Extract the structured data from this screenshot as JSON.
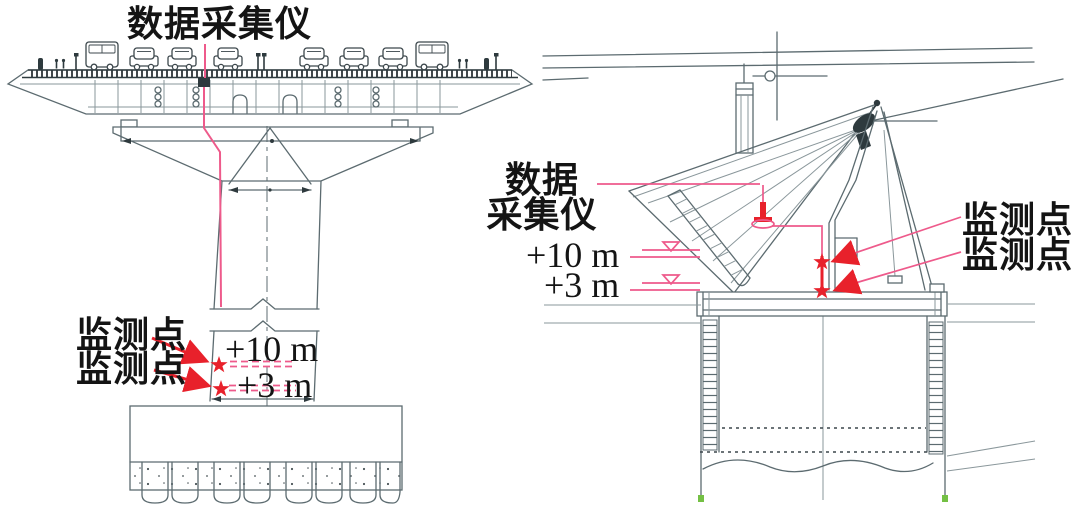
{
  "left_view": {
    "daq_label": "数据采集仪",
    "monitoring_points": [
      "监测点",
      "监测点"
    ],
    "elevations": [
      "+10 m",
      "+3 m"
    ]
  },
  "right_view": {
    "daq_label_lines": [
      "数据",
      "采集仪"
    ],
    "elevations": [
      "+10 m",
      "+3 m"
    ],
    "monitoring_points": [
      "监测点",
      "监测点"
    ]
  },
  "colors": {
    "drawing_line": "#5c6b70",
    "dark_detail": "#2e3a3e",
    "annotation_pink": "#ee5a8b",
    "annotation_red": "#e8212b",
    "pile_tip_green": "#74c044",
    "text": "#141414",
    "background": "#ffffff"
  }
}
